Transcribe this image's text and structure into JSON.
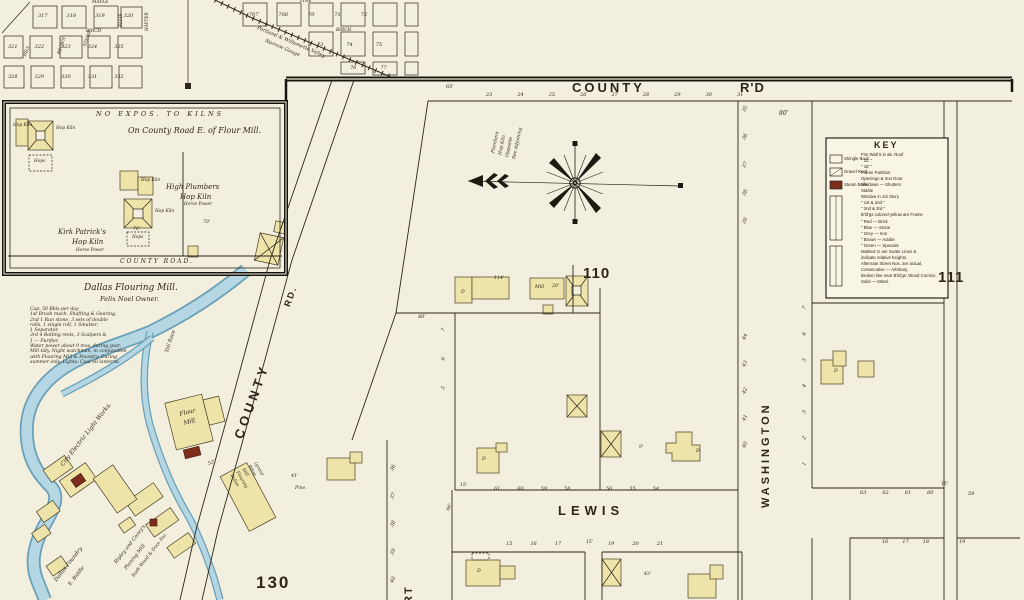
{
  "colors": {
    "paper": "#f3efdf",
    "building_fill": "#eee3a9",
    "water": "#b5d6e3",
    "water_edge": "#69a0b8",
    "boiler_red": "#7c2d1b",
    "line": "#2b2619"
  },
  "streets": {
    "county": "COUNTY",
    "county_rd": "R'D",
    "lewis": "LEWIS",
    "washington": "WASHINGTON",
    "county_diag": "COUNTY",
    "county_diag_rd": "RD.",
    "court_partial": "RT",
    "maple": "MAPLE",
    "birch": "BIRCH",
    "ellis": "ELLIS",
    "hill": "HILL",
    "brown": "BROWN",
    "stump": "STUMP",
    "hayter": "HAYTER",
    "pine": "PINE",
    "birch_e": "BIRCH"
  },
  "blocks": {
    "b110": "110",
    "b111": "111",
    "b130": "130"
  },
  "plat_left": {
    "r1": [
      "317",
      "318",
      "319",
      "320"
    ],
    "r2": [
      "321",
      "322",
      "323",
      "324",
      "325"
    ],
    "r3": [
      "328",
      "329",
      "330",
      "331",
      "332"
    ]
  },
  "plat_right": {
    "r1": [
      "707",
      "708",
      "70",
      "71",
      "72"
    ],
    "r2": [
      "73",
      "74",
      "75"
    ],
    "r3": [
      "76",
      "77"
    ]
  },
  "railroad": {
    "line1": "Portland & Willamette Valley",
    "line2": "Narrow Gauge"
  },
  "memo": {
    "l1": "Plumbers",
    "l2": "Hop Kiln",
    "l3": "Opposite",
    "l4": "See Adjoining"
  },
  "inset": {
    "header": "NO EXPOS. TO KILNS",
    "subtitle": "On County Road E. of Flour Mill.",
    "kirk_l1": "Kirk Patrick's",
    "kirk_l2": "Hop Kiln",
    "kirk_l3": "Horse Power",
    "high_l1": "High Plumbers",
    "high_l2": "Hop Kiln",
    "high_l3": "Horse Power",
    "hk1": "Hop Kiln",
    "hk2": "Hop Kiln",
    "hk3": "Hop Kiln",
    "hk4": "Hop Kiln",
    "hops1": "Hops",
    "hops2": "Hops",
    "d70a": "70'",
    "d70b": "70'",
    "county_road": "COUNTY ROAD."
  },
  "mill_note": {
    "title": "Dallas Flouring Mill.",
    "owner": "Felix Noel Owner.",
    "lines": [
      "Cap. 50 Bbls per day",
      "1st  Brush mach.  Shafting & Gearing,",
      "2nd  1 Run stone,  3 sets of double",
      "rolls,  1 single roll,  1 Smutter,",
      "1 Separator,",
      "3rd  4 Bolting reels,  3 Scalpers &",
      "1 — Purifier,",
      "Water power about 9 mos. during year,",
      "Mill tidy.  Night watchman, in conjunction",
      "with Flouring Mill & Foundry.  During",
      "summer only.  Lights: Coal oil lanterns."
    ]
  },
  "mills": {
    "electric": "City Electric Light Works.",
    "foundry_l1": "Dallas Foundry",
    "foundry_l2": "E. Biddle",
    "ripley_l1": "Ripley and Corey's",
    "ripley_l2": "Planing Mill",
    "ripley_l3": "Sash Wood & Door Fac.",
    "flour_l1": "Flour",
    "flour_l2": "Mill",
    "whse_l1": "Dallas",
    "whse_l2": "Flouring",
    "whse_l3": "Mill",
    "whse_l4": "Whse",
    "whse_l5": "(grain)",
    "tail_race": "Tail Race"
  },
  "key": {
    "title": "KEY",
    "swatches": [
      "Shingle Roof",
      "Gravel Roof",
      "Steam Boiler"
    ],
    "rows": [
      "Fire Wall 5 in ab. Roof",
      "\"   12'   \"",
      "\"   18'   \"",
      "Frame Partition",
      "Openings & Iron Door",
      "Windows — Shutters",
      "Stable",
      "Window in 1st Story",
      "\"   1st & 2nd   \"",
      "\"   2nd & 3rd   \"",
      "B'ld'gs colored yellow are Frame",
      "\"   Red — Brick",
      "\"   Blue — Stone",
      "\"   Grey — Iron",
      "\"   Brown — Adobe",
      "\"   Green — Specials",
      "Marked ⊙ are Gutter Lines &",
      "indicate relative heights.",
      "Alternate Street Nos. are actual,",
      "Consecutive — Arbitrary.",
      "Broken line near B'ld'gs: Wood Cornice,",
      "Solid — Metal."
    ]
  },
  "lots": {
    "county_rd": [
      "23",
      "24",
      "25",
      "26",
      "27",
      "28",
      "29",
      "30",
      "31"
    ],
    "b110_east_upper": [
      "35",
      "36",
      "37",
      "38",
      "39"
    ],
    "b110_east_lower": [
      "44",
      "43",
      "42",
      "41",
      "40"
    ],
    "b111_west": [
      "7",
      "6",
      "5",
      "4",
      "3",
      "2",
      "1"
    ],
    "b110_west": [
      "7",
      "6",
      "5"
    ],
    "court_east": [
      "36",
      "37",
      "38",
      "39",
      "40"
    ],
    "lewis_nw": [
      "61",
      "60",
      "59",
      "58"
    ],
    "lewis_ne": [
      "56",
      "55",
      "54"
    ],
    "lewis_far": [
      "63",
      "62",
      "61",
      "60"
    ],
    "lewis_far2": "59",
    "bottom_l": [
      "15",
      "16",
      "17"
    ],
    "bottom_r": [
      "19",
      "20",
      "21"
    ],
    "bottom_fr": [
      "16",
      "17",
      "18"
    ],
    "bottom_fr2": "19"
  },
  "dims": {
    "d80a": "80'",
    "d80b": "80'",
    "d114": "114'",
    "d20": "20'",
    "d41": "41'",
    "pine_note": "Pine.",
    "d9": "9'",
    "d43": "43'",
    "d52": "52'",
    "d15a": "15'",
    "d15b": "15'",
    "d15c": "15'",
    "d65": "65'",
    "d66": "66'"
  },
  "marks": {
    "m1": "D",
    "m2": "D",
    "m3": "D",
    "m4": "D",
    "m5": "D",
    "mill": "Mill"
  }
}
